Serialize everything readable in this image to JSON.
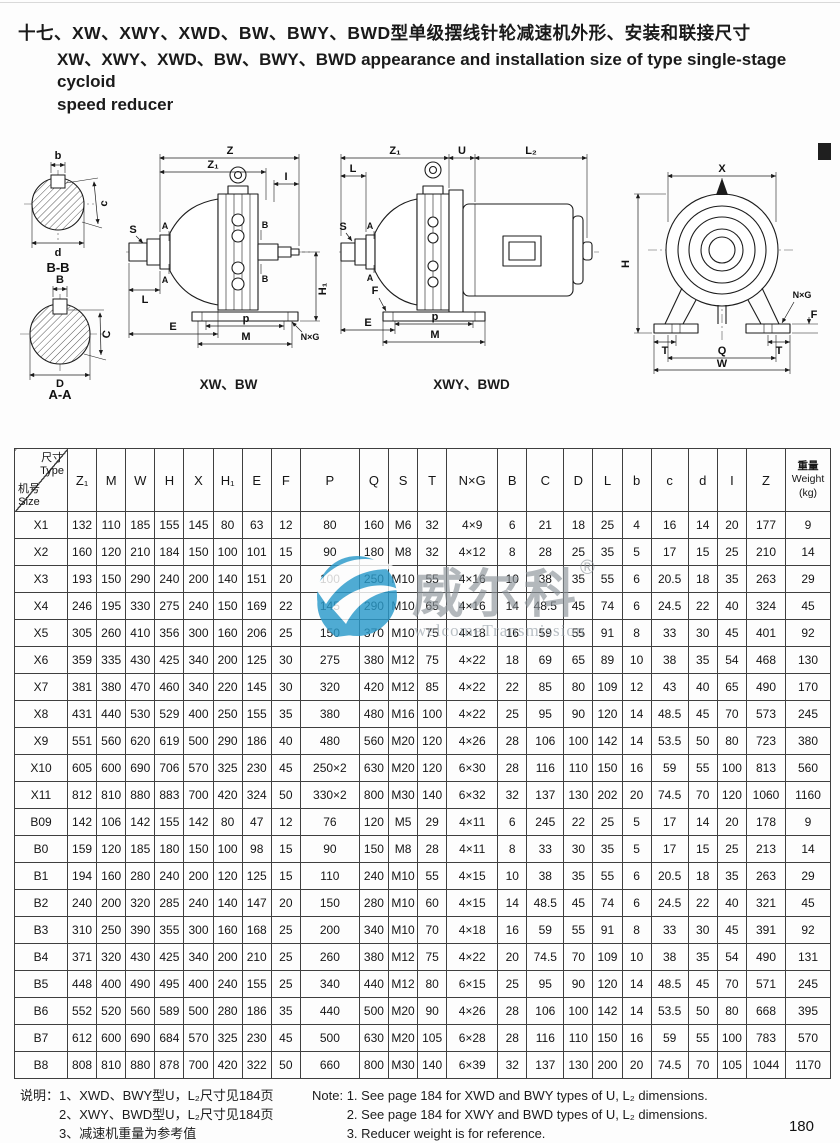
{
  "header": {
    "title_zh": "十七、XW、XWY、XWD、BW、BWY、BWD型单级摆线针轮减速机外形、安装和联接尺寸",
    "title_en_line1": "XW、XWY、XWD、BW、BWY、BWD appearance and installation size of type single-stage cycloid",
    "title_en_line2": "speed reducer"
  },
  "captions": {
    "bb": "B-B",
    "aa": "A-A",
    "xw": "XW、BW",
    "xwy": "XWY、BWD"
  },
  "dims": {
    "Z": "Z",
    "Z1": "Z₁",
    "I": "I",
    "S": "S",
    "A": "A",
    "B": "B",
    "L": "L",
    "E": "E",
    "p": "p",
    "M": "M",
    "H1": "H₁",
    "NxG": "N×G",
    "U": "U",
    "L2": "L₂",
    "F": "F",
    "X": "X",
    "H": "H",
    "T": "T",
    "Q": "Q",
    "W": "W",
    "b": "b",
    "c": "c",
    "d": "d",
    "C": "C",
    "D": "D"
  },
  "watermark": {
    "text": "威尔科",
    "reg": "®",
    "subtext": "welcomeTransmission",
    "logo_color": "#2a9aca"
  },
  "table": {
    "corner": {
      "top_zh": "尺寸",
      "top_en": "Type",
      "bottom_zh": "机号",
      "bottom_en": "Size"
    },
    "columns": [
      "Z₁",
      "M",
      "W",
      "H",
      "X",
      "H₁",
      "E",
      "F",
      "P",
      "Q",
      "S",
      "T",
      "N×G",
      "B",
      "C",
      "D",
      "L",
      "b",
      "c",
      "d",
      "I",
      "Z"
    ],
    "weight_header": [
      "重量",
      "Weight",
      "(kg)"
    ],
    "rows": [
      [
        "X1",
        "132",
        "110",
        "185",
        "155",
        "145",
        "80",
        "63",
        "12",
        "80",
        "160",
        "M6",
        "32",
        "4×9",
        "6",
        "21",
        "18",
        "25",
        "4",
        "16",
        "14",
        "20",
        "177",
        "9"
      ],
      [
        "X2",
        "160",
        "120",
        "210",
        "184",
        "150",
        "100",
        "101",
        "15",
        "90",
        "180",
        "M8",
        "32",
        "4×12",
        "8",
        "28",
        "25",
        "35",
        "5",
        "17",
        "15",
        "25",
        "210",
        "14"
      ],
      [
        "X3",
        "193",
        "150",
        "290",
        "240",
        "200",
        "140",
        "151",
        "20",
        "100",
        "250",
        "M10",
        "55",
        "4×16",
        "10",
        "38",
        "35",
        "55",
        "6",
        "20.5",
        "18",
        "35",
        "263",
        "29"
      ],
      [
        "X4",
        "246",
        "195",
        "330",
        "275",
        "240",
        "150",
        "169",
        "22",
        "145",
        "290",
        "M10",
        "65",
        "4×16",
        "14",
        "48.5",
        "45",
        "74",
        "6",
        "24.5",
        "22",
        "40",
        "324",
        "45"
      ],
      [
        "X5",
        "305",
        "260",
        "410",
        "356",
        "300",
        "160",
        "206",
        "25",
        "150",
        "370",
        "M10",
        "75",
        "4×18",
        "16",
        "59",
        "55",
        "91",
        "8",
        "33",
        "30",
        "45",
        "401",
        "92"
      ],
      [
        "X6",
        "359",
        "335",
        "430",
        "425",
        "340",
        "200",
        "125",
        "30",
        "275",
        "380",
        "M12",
        "75",
        "4×22",
        "18",
        "69",
        "65",
        "89",
        "10",
        "38",
        "35",
        "54",
        "468",
        "130"
      ],
      [
        "X7",
        "381",
        "380",
        "470",
        "460",
        "340",
        "220",
        "145",
        "30",
        "320",
        "420",
        "M12",
        "85",
        "4×22",
        "22",
        "85",
        "80",
        "109",
        "12",
        "43",
        "40",
        "65",
        "490",
        "170"
      ],
      [
        "X8",
        "431",
        "440",
        "530",
        "529",
        "400",
        "250",
        "155",
        "35",
        "380",
        "480",
        "M16",
        "100",
        "4×22",
        "25",
        "95",
        "90",
        "120",
        "14",
        "48.5",
        "45",
        "70",
        "573",
        "245"
      ],
      [
        "X9",
        "551",
        "560",
        "620",
        "619",
        "500",
        "290",
        "186",
        "40",
        "480",
        "560",
        "M20",
        "120",
        "4×26",
        "28",
        "106",
        "100",
        "142",
        "14",
        "53.5",
        "50",
        "80",
        "723",
        "380"
      ],
      [
        "X10",
        "605",
        "600",
        "690",
        "706",
        "570",
        "325",
        "230",
        "45",
        "250×2",
        "630",
        "M20",
        "120",
        "6×30",
        "28",
        "116",
        "110",
        "150",
        "16",
        "59",
        "55",
        "100",
        "813",
        "560"
      ],
      [
        "X11",
        "812",
        "810",
        "880",
        "883",
        "700",
        "420",
        "324",
        "50",
        "330×2",
        "800",
        "M30",
        "140",
        "6×32",
        "32",
        "137",
        "130",
        "202",
        "20",
        "74.5",
        "70",
        "120",
        "1060",
        "1160"
      ],
      [
        "B09",
        "142",
        "106",
        "142",
        "155",
        "142",
        "80",
        "47",
        "12",
        "76",
        "120",
        "M5",
        "29",
        "4×11",
        "6",
        "245",
        "22",
        "25",
        "5",
        "17",
        "14",
        "20",
        "178",
        "9"
      ],
      [
        "B0",
        "159",
        "120",
        "185",
        "180",
        "150",
        "100",
        "98",
        "15",
        "90",
        "150",
        "M8",
        "28",
        "4×11",
        "8",
        "33",
        "30",
        "35",
        "5",
        "17",
        "15",
        "25",
        "213",
        "14"
      ],
      [
        "B1",
        "194",
        "160",
        "280",
        "240",
        "200",
        "120",
        "125",
        "15",
        "110",
        "240",
        "M10",
        "55",
        "4×15",
        "10",
        "38",
        "35",
        "55",
        "6",
        "20.5",
        "18",
        "35",
        "263",
        "29"
      ],
      [
        "B2",
        "240",
        "200",
        "320",
        "285",
        "240",
        "140",
        "147",
        "20",
        "150",
        "280",
        "M10",
        "60",
        "4×15",
        "14",
        "48.5",
        "45",
        "74",
        "6",
        "24.5",
        "22",
        "40",
        "321",
        "45"
      ],
      [
        "B3",
        "310",
        "250",
        "390",
        "355",
        "300",
        "160",
        "168",
        "25",
        "200",
        "340",
        "M10",
        "70",
        "4×18",
        "16",
        "59",
        "55",
        "91",
        "8",
        "33",
        "30",
        "45",
        "391",
        "92"
      ],
      [
        "B4",
        "371",
        "320",
        "430",
        "425",
        "340",
        "200",
        "210",
        "25",
        "260",
        "380",
        "M12",
        "75",
        "4×22",
        "20",
        "74.5",
        "70",
        "109",
        "10",
        "38",
        "35",
        "54",
        "490",
        "131"
      ],
      [
        "B5",
        "448",
        "400",
        "490",
        "495",
        "400",
        "240",
        "155",
        "25",
        "340",
        "440",
        "M12",
        "80",
        "6×15",
        "25",
        "95",
        "90",
        "120",
        "14",
        "48.5",
        "45",
        "70",
        "571",
        "245"
      ],
      [
        "B6",
        "552",
        "520",
        "560",
        "589",
        "500",
        "280",
        "186",
        "35",
        "440",
        "500",
        "M20",
        "90",
        "4×26",
        "28",
        "106",
        "100",
        "142",
        "14",
        "53.5",
        "50",
        "80",
        "668",
        "395"
      ],
      [
        "B7",
        "612",
        "600",
        "690",
        "684",
        "570",
        "325",
        "230",
        "45",
        "500",
        "630",
        "M20",
        "105",
        "6×28",
        "28",
        "116",
        "110",
        "150",
        "16",
        "59",
        "55",
        "100",
        "783",
        "570"
      ],
      [
        "B8",
        "808",
        "810",
        "880",
        "878",
        "700",
        "420",
        "322",
        "50",
        "660",
        "800",
        "M30",
        "140",
        "6×39",
        "32",
        "137",
        "130",
        "200",
        "20",
        "74.5",
        "70",
        "105",
        "1044",
        "1170"
      ]
    ]
  },
  "notes": {
    "zh_label": "说明：",
    "zh_items": [
      "1、XWD、BWY型U，L₂尺寸见184页",
      "2、XWY、BWD型U，L₂尺寸见184页",
      "3、减速机重量为参考值"
    ],
    "en_label": "Note:",
    "en_items": [
      "1. See page 184 for XWD and BWY types of U, L₂ dimensions.",
      "2. See page 184 for XWY and BWD types of U, L₂ dimensions.",
      "3. Reducer weight is for reference."
    ]
  },
  "footer": {
    "page_number": "180"
  }
}
